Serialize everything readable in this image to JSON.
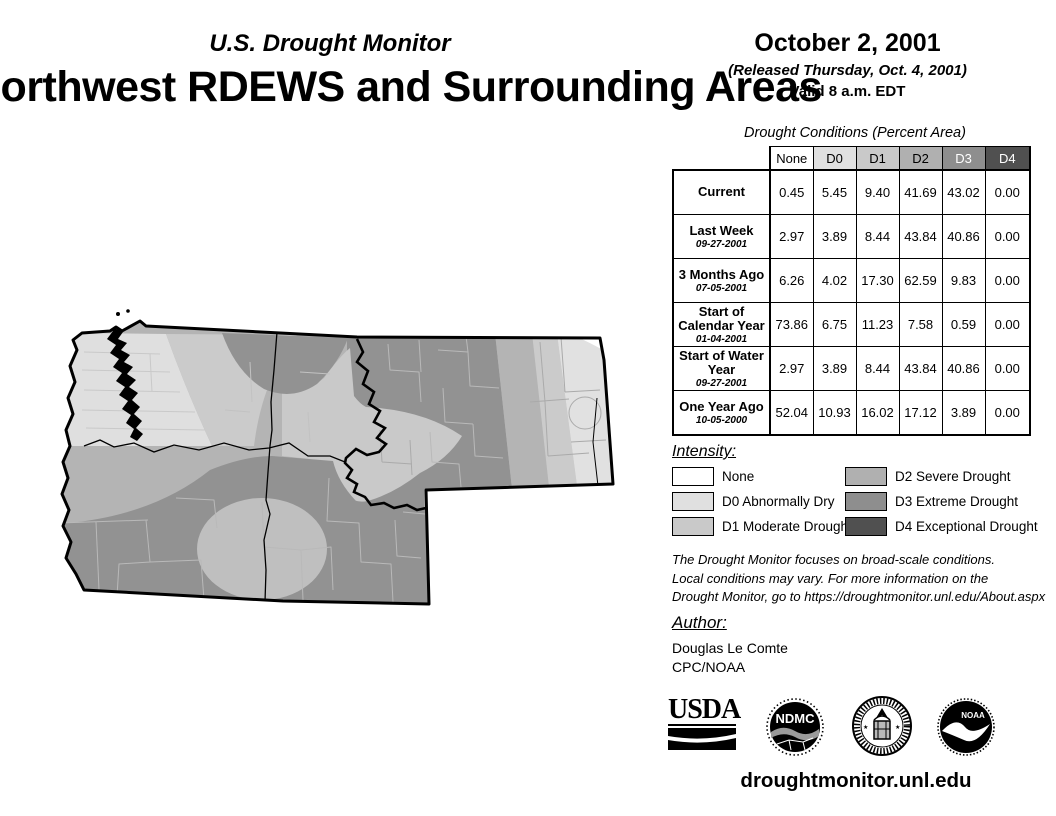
{
  "header": {
    "monitor_title": "U.S. Drought Monitor",
    "region_title": "Northwest RDEWS and Surrounding Areas",
    "date": "October 2, 2001",
    "released": "(Released Thursday, Oct. 4, 2001)",
    "valid": "Valid 8 a.m. EDT"
  },
  "table": {
    "title": "Drought Conditions (Percent Area)",
    "columns": [
      "None",
      "D0",
      "D1",
      "D2",
      "D3",
      "D4"
    ],
    "column_colors": [
      "#ffffff",
      "#e0e0e0",
      "#c9c9c9",
      "#b0b0b0",
      "#8e8e8e",
      "#505050"
    ],
    "rows": [
      {
        "label": "Current",
        "date": "",
        "values": [
          "0.45",
          "5.45",
          "9.40",
          "41.69",
          "43.02",
          "0.00"
        ]
      },
      {
        "label": "Last Week",
        "date": "09-27-2001",
        "values": [
          "2.97",
          "3.89",
          "8.44",
          "43.84",
          "40.86",
          "0.00"
        ]
      },
      {
        "label": "3 Months Ago",
        "date": "07-05-2001",
        "values": [
          "6.26",
          "4.02",
          "17.30",
          "62.59",
          "9.83",
          "0.00"
        ]
      },
      {
        "label": "Start of Calendar Year",
        "date": "01-04-2001",
        "values": [
          "73.86",
          "6.75",
          "11.23",
          "7.58",
          "0.59",
          "0.00"
        ]
      },
      {
        "label": "Start of Water Year",
        "date": "09-27-2001",
        "values": [
          "2.97",
          "3.89",
          "8.44",
          "43.84",
          "40.86",
          "0.00"
        ]
      },
      {
        "label": "One Year Ago",
        "date": "10-05-2000",
        "values": [
          "52.04",
          "10.93",
          "16.02",
          "17.12",
          "3.89",
          "0.00"
        ]
      }
    ]
  },
  "legend": {
    "title": "Intensity:",
    "items": [
      {
        "label": "None",
        "color": "#ffffff"
      },
      {
        "label": "D0 Abnormally Dry",
        "color": "#e0e0e0"
      },
      {
        "label": "D1 Moderate Drought",
        "color": "#c9c9c9"
      },
      {
        "label": "D2 Severe Drought",
        "color": "#b0b0b0"
      },
      {
        "label": "D3 Extreme Drought",
        "color": "#8e8e8e"
      },
      {
        "label": "D4 Exceptional Drought",
        "color": "#505050"
      }
    ]
  },
  "disclaimer": {
    "lines": [
      "The Drought Monitor focuses on broad-scale conditions.",
      "Local conditions may vary. For more information on the",
      "Drought Monitor, go to https://droughtmonitor.unl.edu/About.aspx"
    ]
  },
  "author": {
    "title": "Author:",
    "name": "Douglas Le Comte",
    "org": "CPC/NOAA"
  },
  "footer": {
    "url": "droughtmonitor.unl.edu",
    "logos": [
      {
        "name": "usda",
        "text": "USDA"
      },
      {
        "name": "ndmc",
        "text": "NDMC"
      },
      {
        "name": "department-of-commerce-seal",
        "text": ""
      },
      {
        "name": "noaa",
        "text": "NOAA"
      }
    ]
  }
}
